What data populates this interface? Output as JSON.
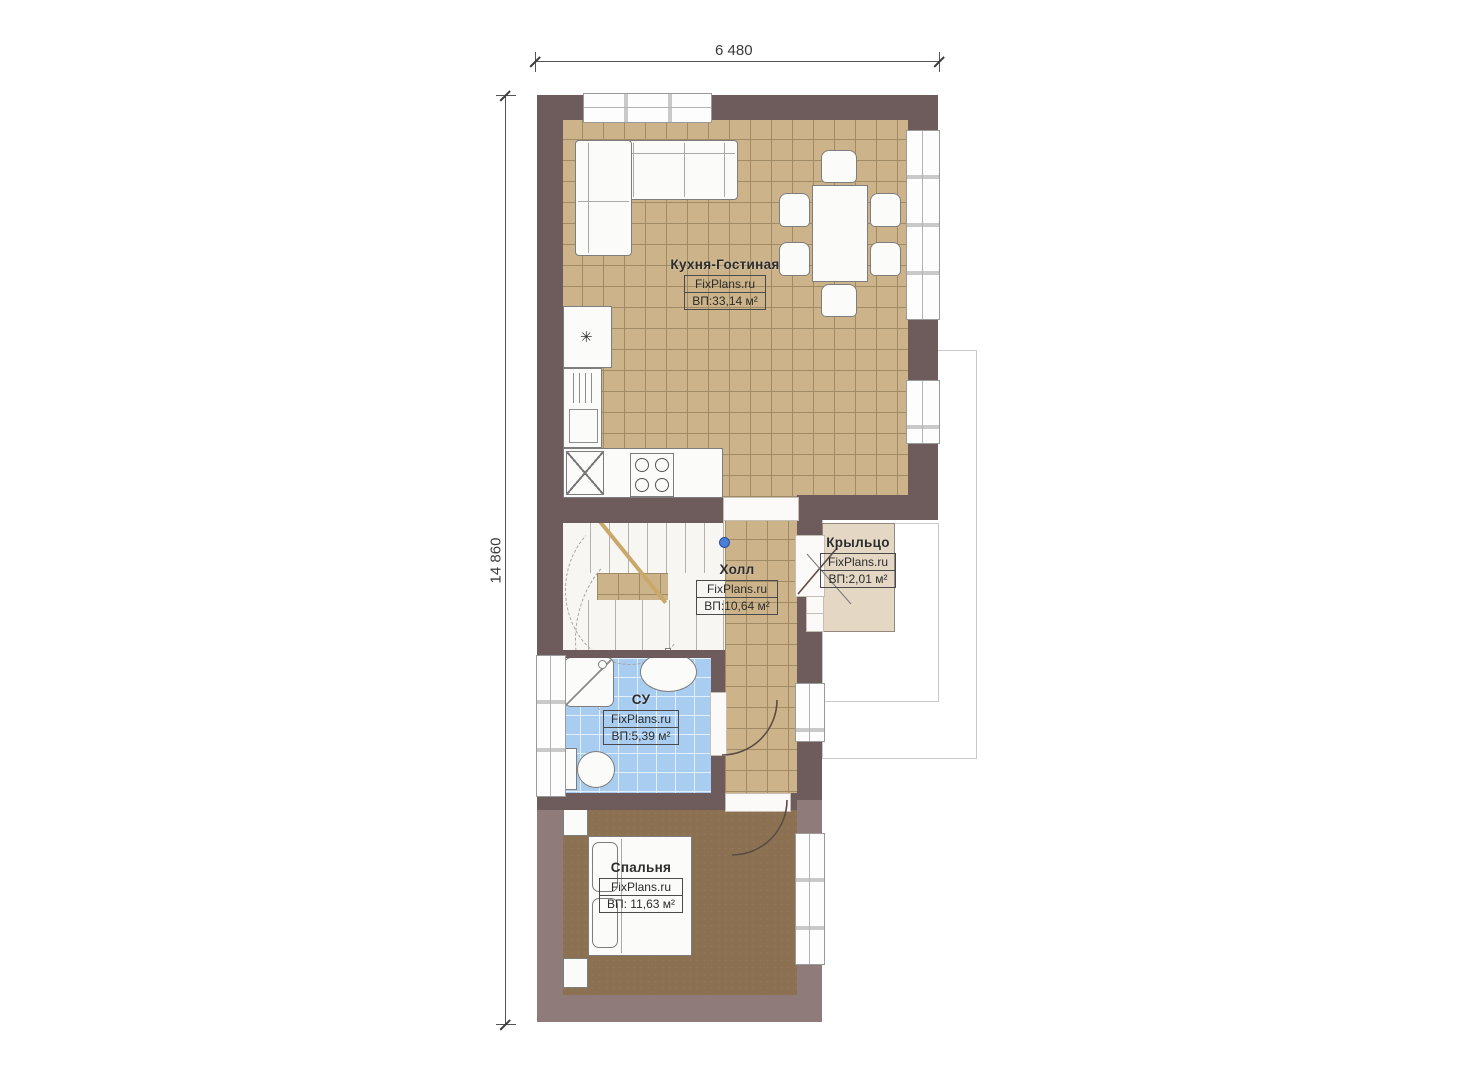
{
  "dimensions": {
    "top": "6 480",
    "left": "14 860"
  },
  "rooms": {
    "kitchen": {
      "name": "Кухня-Гостиная",
      "site": "FixPlans.ru",
      "area": "ВП:33,14 м²"
    },
    "hall": {
      "name": "Холл",
      "site": "FixPlans.ru",
      "area": "ВП:10,64 м²"
    },
    "porch": {
      "name": "Крыльцо",
      "site": "FixPlans.ru",
      "area": "ВП:2,01 м²"
    },
    "bathroom": {
      "name": "СУ",
      "site": "FixPlans.ru",
      "area": "ВП:5,39 м²"
    },
    "bedroom": {
      "name": "Спальня",
      "site": "FixPlans.ru",
      "area": "ВП: 11,63 м²"
    }
  },
  "icons": {
    "freezer": "✳"
  },
  "colors": {
    "wall_dark": "#6e5b5c",
    "wall_light": "#8e7b7a",
    "tile_tan": "#ccb38a",
    "tile_blue": "#a9cdf0",
    "floor_bedroom": "#8b7152",
    "floor_porch": "#e4d7c3"
  }
}
